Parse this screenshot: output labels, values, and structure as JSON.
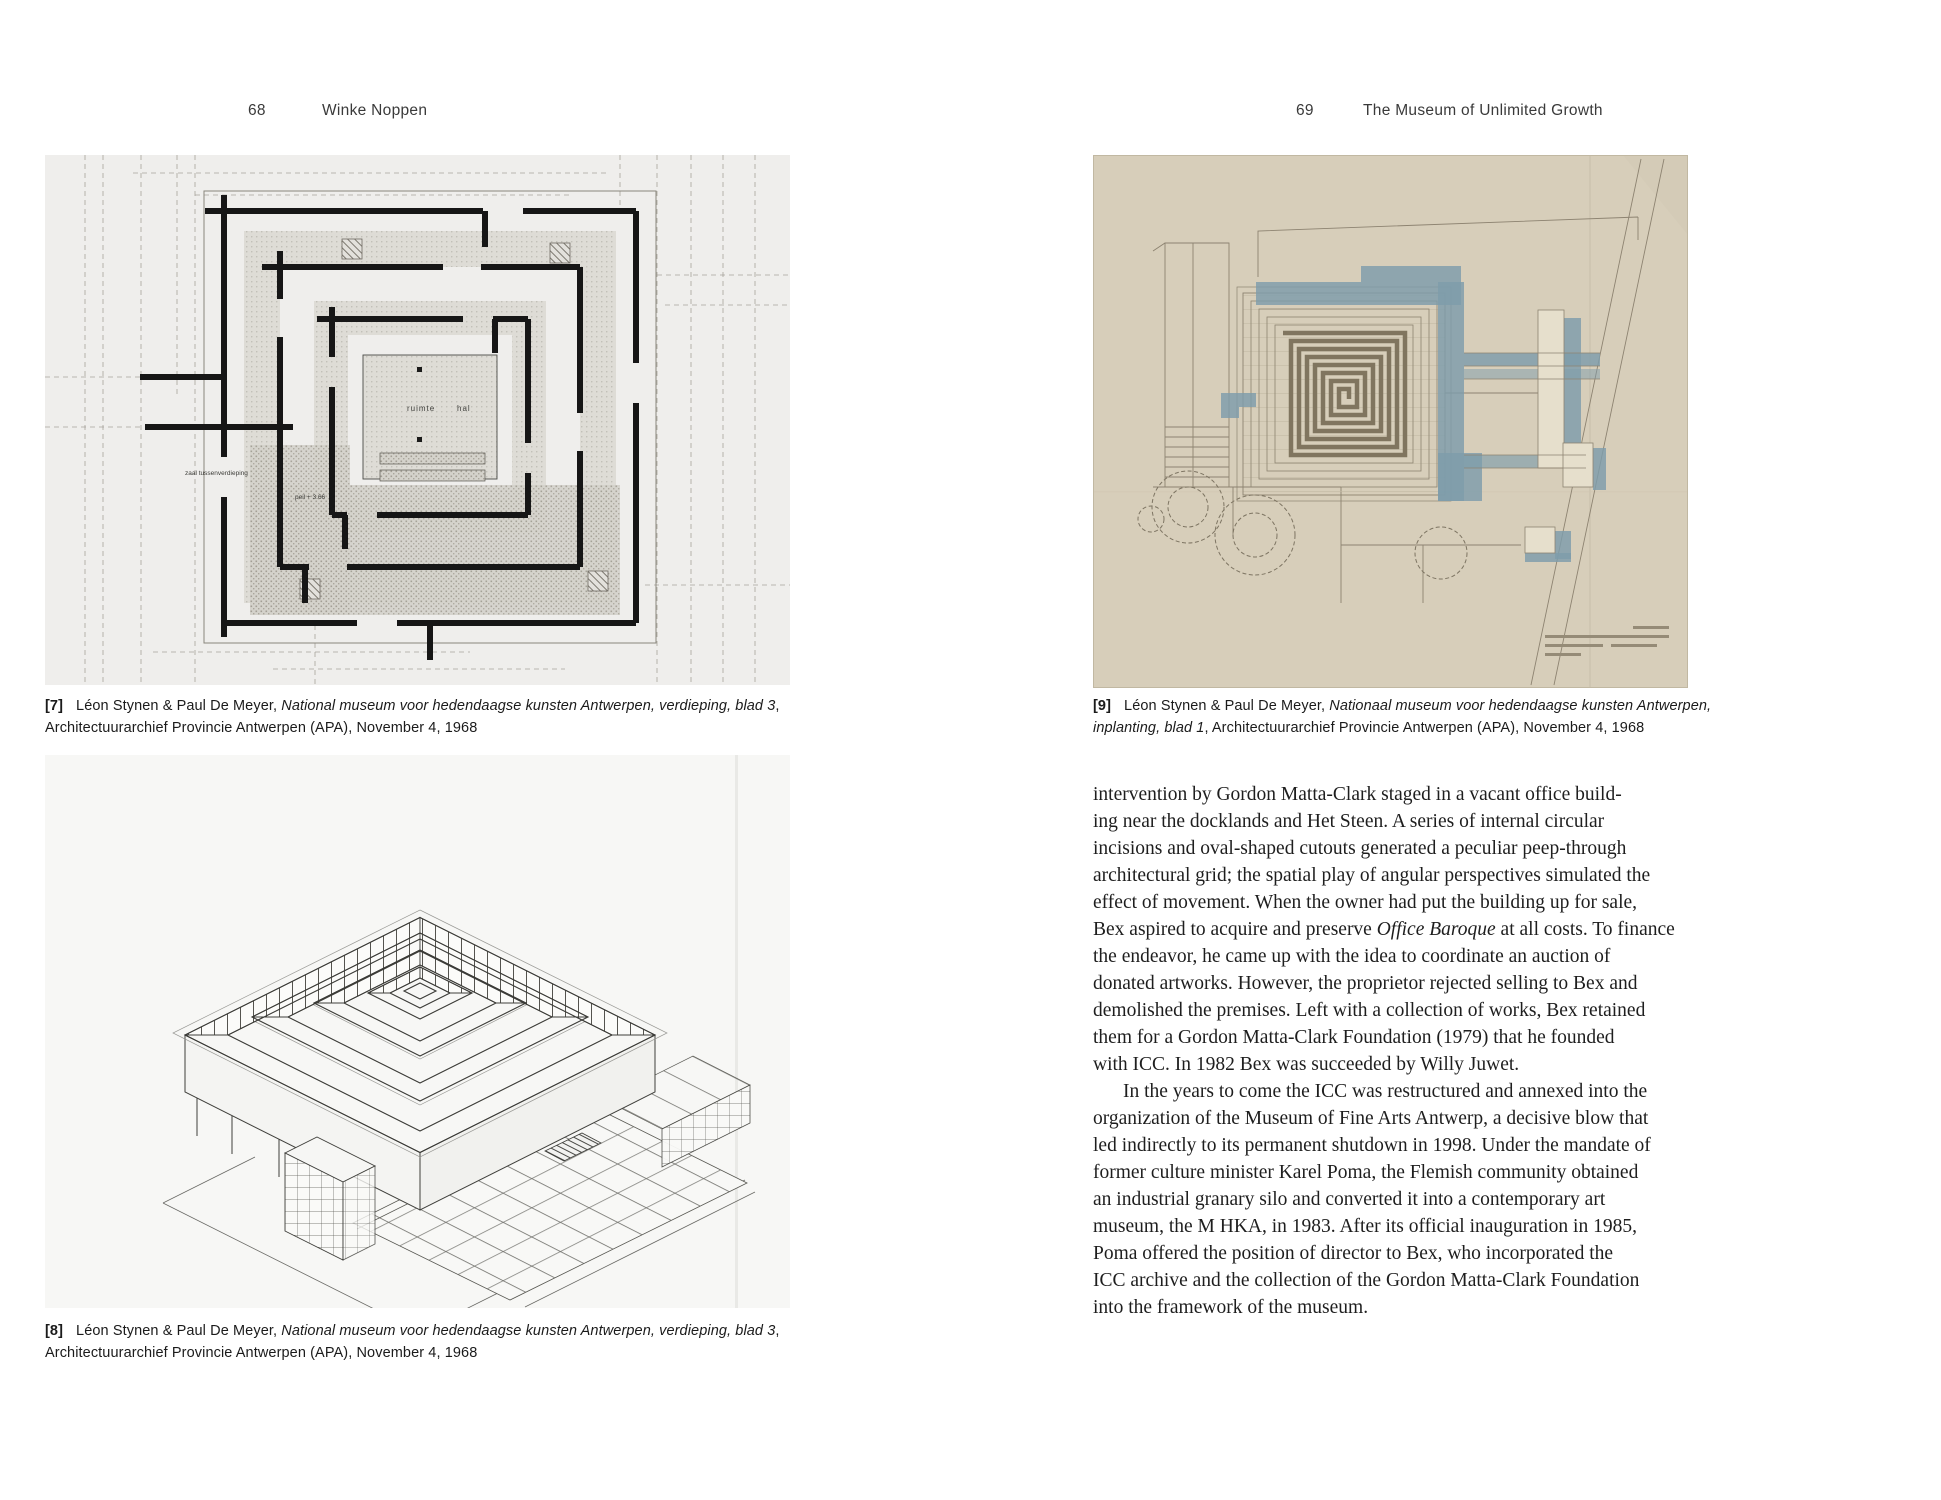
{
  "left_page": {
    "page_number": "68",
    "running_title": "Winke Noppen",
    "figure7": {
      "label": "[7]",
      "caption": "Léon Stynen & Paul De Meyer, *National museum voor hedendaagse kunsten Antwerpen, verdieping, blad 3*, Architectuurarchief Provincie Antwerpen (APA), November 4, 1968",
      "drawing_labels": [
        "ruimte",
        "hal",
        "zaal tussenverdieping",
        "peil + 3.66"
      ]
    },
    "figure8": {
      "label": "[8]",
      "caption": "Léon Stynen & Paul De Meyer, *National museum voor hedendaagse kunsten Antwerpen, verdieping, blad 3*, Architectuurarchief Provincie Antwerpen (APA), November 4, 1968"
    }
  },
  "right_page": {
    "page_number": "69",
    "running_title": "The Museum of Unlimited Growth",
    "figure9": {
      "label": "[9]",
      "caption": "Léon Stynen & Paul De Meyer, *Nationaal museum voor hedendaagse kunsten Antwerpen, inplanting, blad 1*, Architectuurarchief Provincie Antwerpen (APA), November 4, 1968"
    },
    "body": {
      "paragraphs": [
        {
          "indent": false,
          "lines": [
            "intervention by Gordon Matta-Clark staged in a vacant office build-",
            "ing near the docklands and Het Steen. A series of internal circular",
            "incisions and oval-shaped cutouts generated a peculiar peep-through",
            "architectural grid; the spatial play of angular perspectives simulated the",
            "effect of movement. When the owner had put the building up for sale,",
            "Bex aspired to acquire and preserve *Office Baroque* at all costs. To finance",
            "the endeavor, he came up with the idea to coordinate an auction of",
            "donated artworks. However, the proprietor rejected selling to Bex and",
            "demolished the premises. Left with a collection of works, Bex retained",
            "them for a Gordon Matta-Clark Foundation (1979) that he founded",
            "with ICC. In 1982 Bex was succeeded by Willy Juwet."
          ]
        },
        {
          "indent": true,
          "lines": [
            "In the years to come the ICC was restructured and annexed into the",
            "organization of the Museum of Fine Arts Antwerp, a decisive blow that",
            "led indirectly to its permanent shutdown in 1998. Under the mandate of",
            "former culture minister Karel Poma, the Flemish community obtained",
            "an industrial granary silo and converted it into a contemporary art",
            "museum, the M HKA, in 1983. After its official inauguration in 1985,",
            "Poma offered the position of director to Bex, who incorporated the",
            "ICC archive and the collection of the Gordon Matta-Clark Foundation",
            "into the framework of the museum."
          ]
        }
      ]
    }
  },
  "colors": {
    "paper": "#ffffff",
    "ink": "#1e1e1e",
    "plan_paper": "#efeeec",
    "axon_paper": "#f7f7f5",
    "site_paper": "#d7ceba",
    "site_blue": "#7e9cab"
  }
}
